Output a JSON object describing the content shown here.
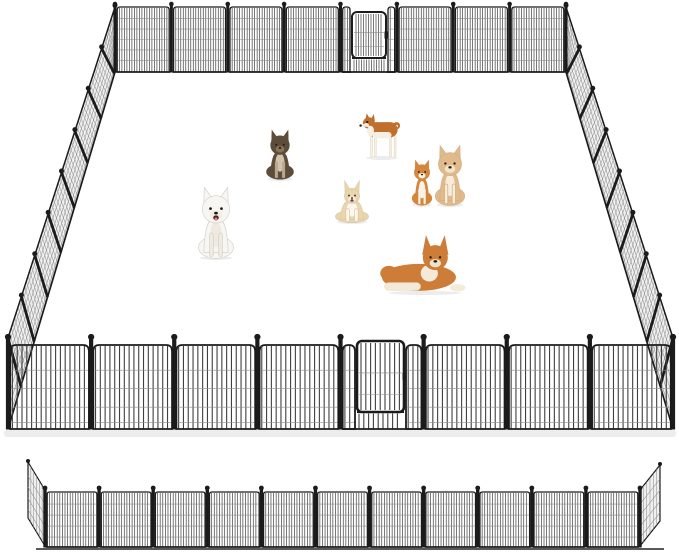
{
  "meta": {
    "alt": "Black metal wire dog playpen arranged as a large rectangular outdoor pen with a walk-through gate on the back wall and the front wall, seven dogs inside the pen, and a straight display row of fence panels shown below",
    "width": 679,
    "height": 553,
    "background": "#ffffff"
  },
  "palette": {
    "frame": "#1b1b1b",
    "wire": "#3f3f3f",
    "wire_light": "#8d8d8d",
    "side_mesh_fill": "#efefef",
    "side_wire": "#8f8f8f",
    "shadow": "#dedede",
    "ground_line": "#222222"
  },
  "pen": {
    "back_wall": {
      "x1": 115,
      "x2": 566,
      "top": 7,
      "bottom": 72,
      "finial_y": 4,
      "panels": 8,
      "wire_step": 2.5,
      "wire_w": 0.7,
      "post_w": 3,
      "finial_r": 2.3,
      "corner_r": 3,
      "frame_w": 1.3,
      "h_wires": [
        0.18,
        0.34,
        0.5,
        0.66,
        0.82
      ],
      "gate": {
        "index": 4,
        "frame_w": 2,
        "door": {
          "x1": 352,
          "x2": 386,
          "top": 12,
          "bottom": 58
        }
      }
    },
    "front_wall": {
      "x1": 8,
      "x2": 673,
      "top": 345,
      "bottom": 429,
      "finial_y": 337,
      "panels": 8,
      "wire_step": 4.8,
      "wire_w": 1.1,
      "post_w": 4.2,
      "finial_r": 3.1,
      "corner_r": 6,
      "frame_w": 1.8,
      "h_wires": [
        0.3,
        0.52,
        0.74,
        0.92
      ],
      "gate": {
        "index": 4,
        "frame_w": 2.6,
        "door": {
          "x1": 357,
          "x2": 404,
          "top": 341,
          "bottom": 412
        }
      }
    },
    "left_wall": {
      "top_edge": [
        [
          115,
          7
        ],
        [
          8,
          338
        ]
      ],
      "bottom_edge": [
        [
          115,
          72
        ],
        [
          8,
          429
        ]
      ],
      "panels": 8,
      "lean": 0.12,
      "wires": 64,
      "h_wires": [
        0.1,
        0.24,
        0.38,
        0.52,
        0.66,
        0.8,
        0.92
      ]
    },
    "right_wall": {
      "top_edge": [
        [
          566,
          7
        ],
        [
          673,
          338
        ]
      ],
      "bottom_edge": [
        [
          566,
          72
        ],
        [
          673,
          429
        ]
      ],
      "panels": 8,
      "lean": 0.12,
      "wires": 64,
      "h_wires": [
        0.1,
        0.24,
        0.38,
        0.52,
        0.66,
        0.8,
        0.92
      ]
    },
    "front_shadow": {
      "x": 4,
      "y": 430,
      "w": 672,
      "h": 7
    }
  },
  "display_row": {
    "x1": 45,
    "x2": 640,
    "top": 492,
    "bottom": 547,
    "finial_y": 488,
    "panels": 11,
    "wire_step": 2.6,
    "wire_w": 0.7,
    "post_w": 3.4,
    "finial_r": 2.4,
    "corner_r": 2.5,
    "frame_w": 1.3,
    "h_wires": [
      0.22,
      0.42,
      0.62,
      0.82
    ],
    "ground_line": {
      "x1": 36,
      "x2": 664,
      "y": 549
    },
    "left_wing": {
      "pivot_top": [
        45,
        490
      ],
      "pivot_bottom": [
        45,
        546
      ],
      "outer_top": [
        28,
        462
      ],
      "outer_bottom": [
        28,
        518
      ]
    },
    "right_wing": {
      "pivot_top": [
        640,
        490
      ],
      "pivot_bottom": [
        640,
        546
      ],
      "outer_top": [
        660,
        465
      ],
      "outer_bottom": [
        660,
        521
      ]
    }
  },
  "dogs": [
    {
      "id": "longhair-chihuahua",
      "label": "gray long-haired puppy sitting",
      "pose": "sitting",
      "x": 265,
      "y": 134,
      "w": 30,
      "h": 46,
      "coat": "#5d4c3a",
      "chest": "#cfc3ae",
      "muzzle": "#8a7458",
      "legs": "#b9a98c",
      "open_mouth": false
    },
    {
      "id": "shiba-inu",
      "label": "red shiba inu standing",
      "pose": "standing",
      "x": 363,
      "y": 114,
      "w": 38,
      "h": 45,
      "coat": "#c0702c",
      "chest": "#f6f0e4"
    },
    {
      "id": "samoyed",
      "label": "white samoyed sitting",
      "pose": "sitting",
      "x": 197,
      "y": 194,
      "w": 38,
      "h": 65,
      "coat": "#f8f6f2",
      "chest": "#eeeae2",
      "muzzle": "#f1ede6",
      "outline": "#d7d3cb",
      "open_mouth": true
    },
    {
      "id": "corgi",
      "label": "cream corgi sitting",
      "pose": "sitting",
      "x": 334,
      "y": 187,
      "w": 36,
      "h": 36,
      "coat": "#e9d6ae",
      "chest": "#fbf7ef",
      "muzzle": "#f7f2e7",
      "ear_scale": 1.35,
      "open_mouth": true,
      "outline": "#dcc9a4"
    },
    {
      "id": "chihuahua-puppy",
      "label": "orange and white chihuahua puppy sitting",
      "pose": "sitting",
      "x": 411,
      "y": 163,
      "w": 22,
      "h": 43,
      "coat": "#d4863c",
      "chest": "#f8f2e7",
      "legs": "#f8f2e7"
    },
    {
      "id": "shiba-puppy",
      "label": "cream shiba puppy sitting",
      "pose": "sitting",
      "x": 434,
      "y": 151,
      "w": 32,
      "h": 55,
      "coat": "#e0ba8a",
      "chest": "#f7ecd9",
      "muzzle": "#f2e3c9",
      "outline": "#d2af86"
    },
    {
      "id": "spitz-lying",
      "label": "orange spitz dog lying down",
      "pose": "lying",
      "x": 382,
      "y": 242,
      "w": 86,
      "h": 52,
      "coat": "#cd7d37",
      "chest": "#f4ead9",
      "muzzle": "#f0e2cc"
    }
  ]
}
